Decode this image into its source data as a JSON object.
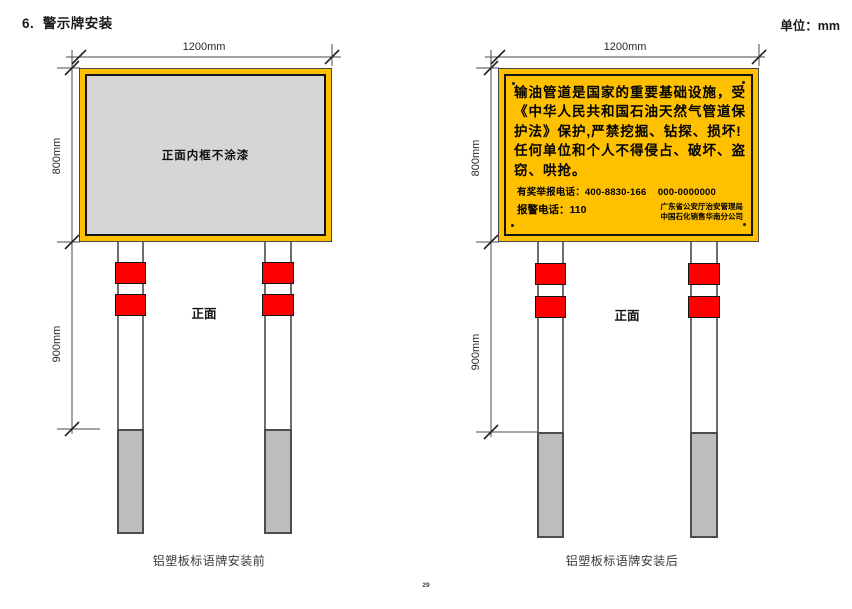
{
  "page": {
    "heading": "6.  警示牌安装",
    "unit_label": "单位：mm",
    "page_number": "29"
  },
  "colors": {
    "sign_yellow": "#FFC000",
    "band_red": "#FF0000",
    "panel_gray": "#D6D6D6",
    "underground_gray": "#BDBDBD"
  },
  "diagrams": {
    "before": {
      "width_dim": "1200mm",
      "height_dim": "800mm",
      "post_dim": "900mm",
      "panel_text": "正面内框不涂漆",
      "front_label": "正面",
      "caption": "铝塑板标语牌安装前"
    },
    "after": {
      "width_dim": "1200mm",
      "height_dim": "800mm",
      "post_dim": "900mm",
      "front_label": "正面",
      "caption": "铝塑板标语牌安装后",
      "sign": {
        "lines": [
          "输油管道是国家的重要基础设施，受",
          "《中华人民共和国石油天然气管道保",
          "护法》保护,严禁挖掘、钻探、损坏!",
          "任何单位和个人不得侵占、破坏、盗",
          "窃、哄抢。"
        ],
        "hotline": "有奖举报电话：400-8830-166    000-0000000",
        "police": "报警电话：110",
        "org_line1": "广东省公安厅治安管理局",
        "org_line2": "中国石化销售华南分公司"
      }
    }
  }
}
